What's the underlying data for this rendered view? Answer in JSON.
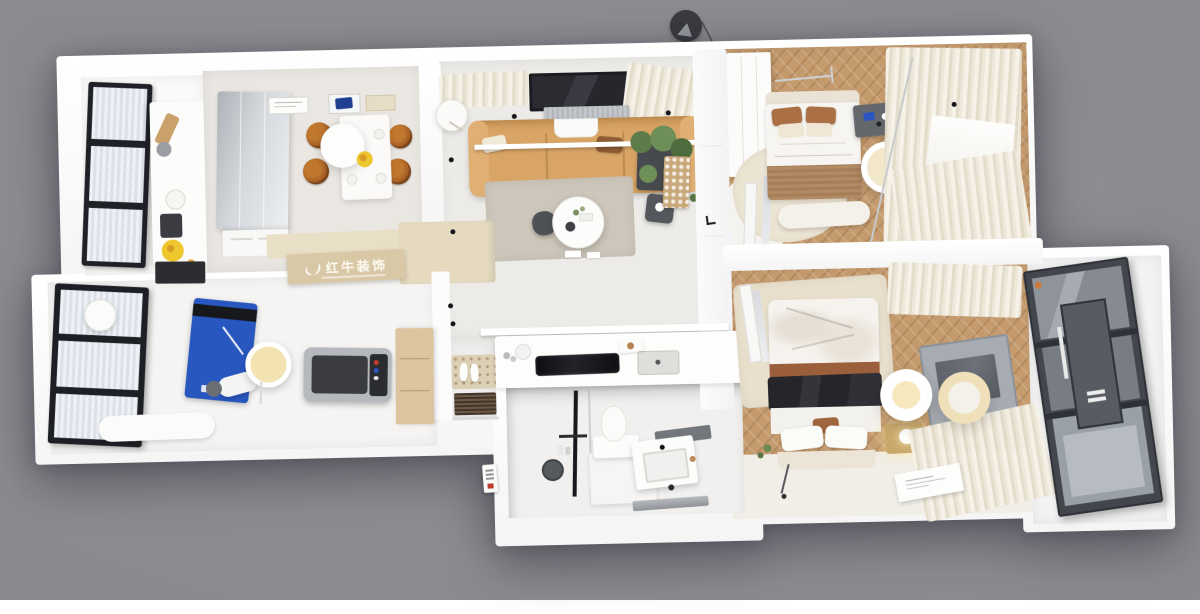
{
  "scene": {
    "title": "Top-down 3D apartment floor plan render",
    "background_color": "#8a8a8f",
    "watermark": {
      "brand": "红牛装饰"
    },
    "palette": {
      "wall": "#ffffff",
      "wood_floor": "#c59b6e",
      "sofa_tan": "#d9a566",
      "island_beige": "#d9c8a5",
      "yoga_mat_blue": "#2857bf",
      "treadmill_gray": "#3b3d41",
      "balcony_glass": "#43464c",
      "curtain_cream": "#efe9dc",
      "fruit_yellow": "#eec62e",
      "window_frame_black": "#202127"
    }
  },
  "rooms": [
    {
      "id": "kitchen-balcony",
      "label": "Kitchen balcony with black framed windows",
      "items": [
        "window-wall",
        "prep-counter",
        "cutting-board",
        "kettle",
        "coffee-machine",
        "fruit-bowl",
        "base-cabinet"
      ]
    },
    {
      "id": "dining-room",
      "label": "Dining room",
      "items": [
        "glass-wardrobe",
        "wall-art",
        "pendant-disc",
        "dining-table",
        "rattan-chairs",
        "fruit-plate",
        "sideboard"
      ]
    },
    {
      "id": "living-room",
      "label": "Living room",
      "items": [
        "curtains",
        "window",
        "ac-unit",
        "floor-lamp",
        "sofa",
        "wall-shelf",
        "pillows",
        "plant",
        "side-table",
        "lattice-screen",
        "rug",
        "coffee-table",
        "spotlights"
      ]
    },
    {
      "id": "entry-hall",
      "label": "Entry hall and open kitchen bar",
      "items": [
        "island-bar",
        "cooktop",
        "sink",
        "paper-towel",
        "shoe-mat",
        "slippers",
        "doormat",
        "tall-cabinet"
      ]
    },
    {
      "id": "gym-room",
      "label": "Home gym",
      "items": [
        "window-wall",
        "round-stool",
        "yoga-mat",
        "ring-light",
        "exercise-bench",
        "treadmill",
        "storage-bench"
      ]
    },
    {
      "id": "bathroom",
      "label": "Bathroom pod",
      "items": [
        "shower-set",
        "glass-screen",
        "toilet",
        "platform",
        "vanity-sink",
        "shower-tray"
      ]
    },
    {
      "id": "bedroom-small",
      "label": "Small bedroom",
      "items": [
        "wardrobe",
        "bed",
        "brown-pillows",
        "knit-throw",
        "bench",
        "rug",
        "floor-mirror",
        "desk",
        "round-stool",
        "curtains",
        "window"
      ]
    },
    {
      "id": "bedroom-master",
      "label": "Master bedroom",
      "items": [
        "rug",
        "floor-mirror",
        "bed",
        "black-throw",
        "pillows",
        "nightstand",
        "table-lamp",
        "pendant-lights",
        "tv-panel",
        "curtains",
        "floor-poster"
      ]
    },
    {
      "id": "balcony-right",
      "label": "Glazed balcony",
      "items": [
        "glass-sliding-doors"
      ]
    }
  ],
  "exterior": {
    "pendant_lamp": "hanging-lamp",
    "entry_plaque": "brand-plaque"
  }
}
